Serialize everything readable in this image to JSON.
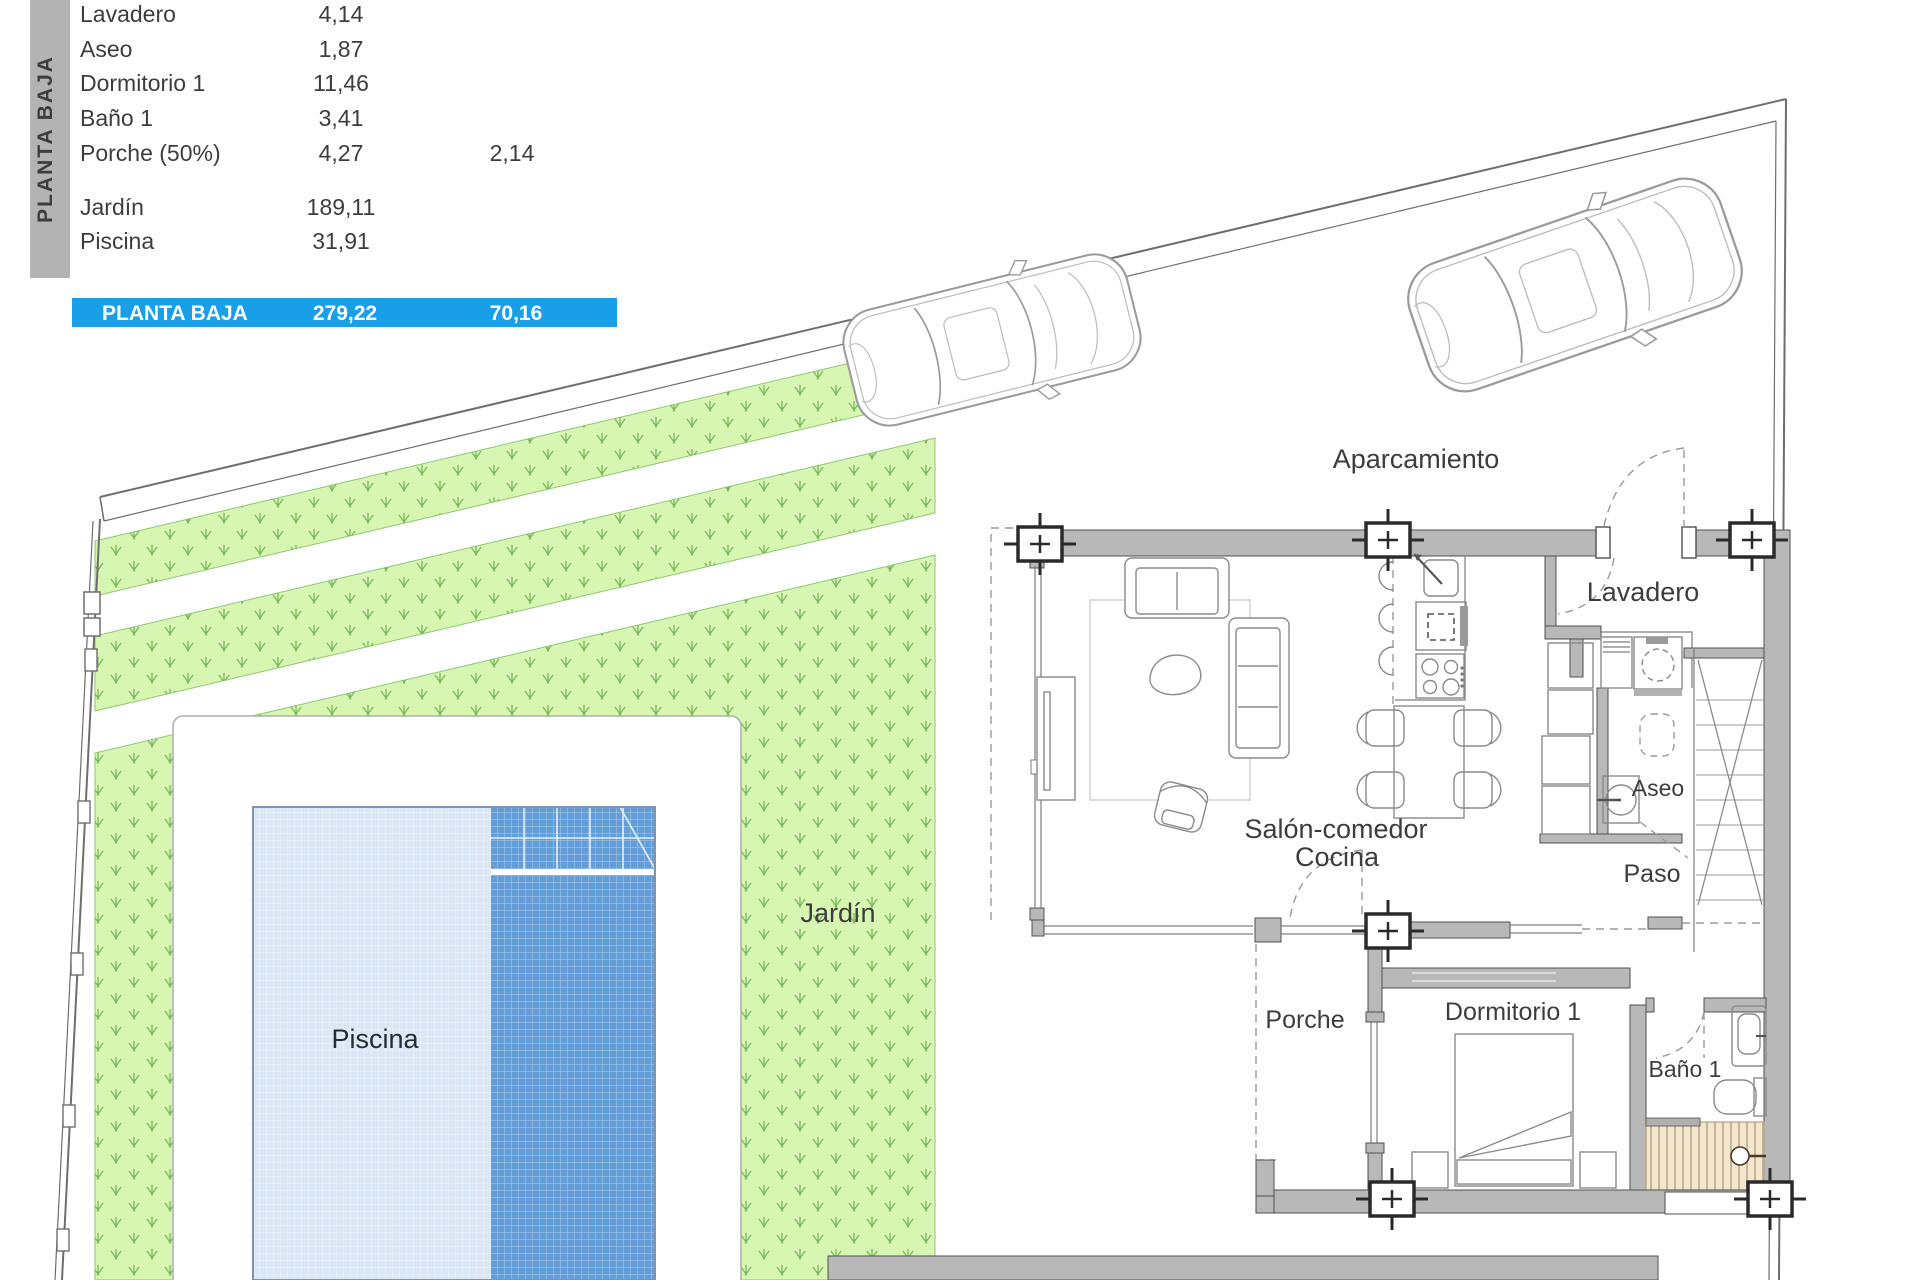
{
  "sidebar": {
    "floor_label": "PLANTA BAJA"
  },
  "area_table": {
    "rows": [
      {
        "name": "Lavadero",
        "value": "4,14",
        "value2": ""
      },
      {
        "name": "Aseo",
        "value": "1,87",
        "value2": ""
      },
      {
        "name": "Dormitorio 1",
        "value": "11,46",
        "value2": ""
      },
      {
        "name": "Baño 1",
        "value": "3,41",
        "value2": ""
      },
      {
        "name": "Porche (50%)",
        "value": "4,27",
        "value2": "2,14"
      },
      {
        "name": "Jardín",
        "value": "189,11",
        "value2": ""
      },
      {
        "name": "Piscina",
        "value": "31,91",
        "value2": ""
      }
    ],
    "total": {
      "label": "PLANTA BAJA",
      "built": "279,22",
      "useful": "70,16"
    }
  },
  "plan": {
    "labels": {
      "aparcamiento": "Aparcamiento",
      "lavadero": "Lavadero",
      "aseo": "Aseo",
      "paso": "Paso",
      "salon": "Salón-comedor",
      "cocina": "Cocina",
      "porche": "Porche",
      "dormitorio": "Dormitorio 1",
      "bano": "Baño 1",
      "jardin": "Jardín",
      "piscina": "Piscina"
    }
  },
  "colors": {
    "banner_blue": "#189fe8",
    "sidebar_gray": "#b3b3b3",
    "wall_gray": "#b8b8b8",
    "garden_green": "#d6f6b2",
    "garden_hatch": "#79b95c",
    "pool_light": "#dbe7f5",
    "pool_dark": "#649ed8",
    "shower_tan": "#f3e6cf"
  }
}
